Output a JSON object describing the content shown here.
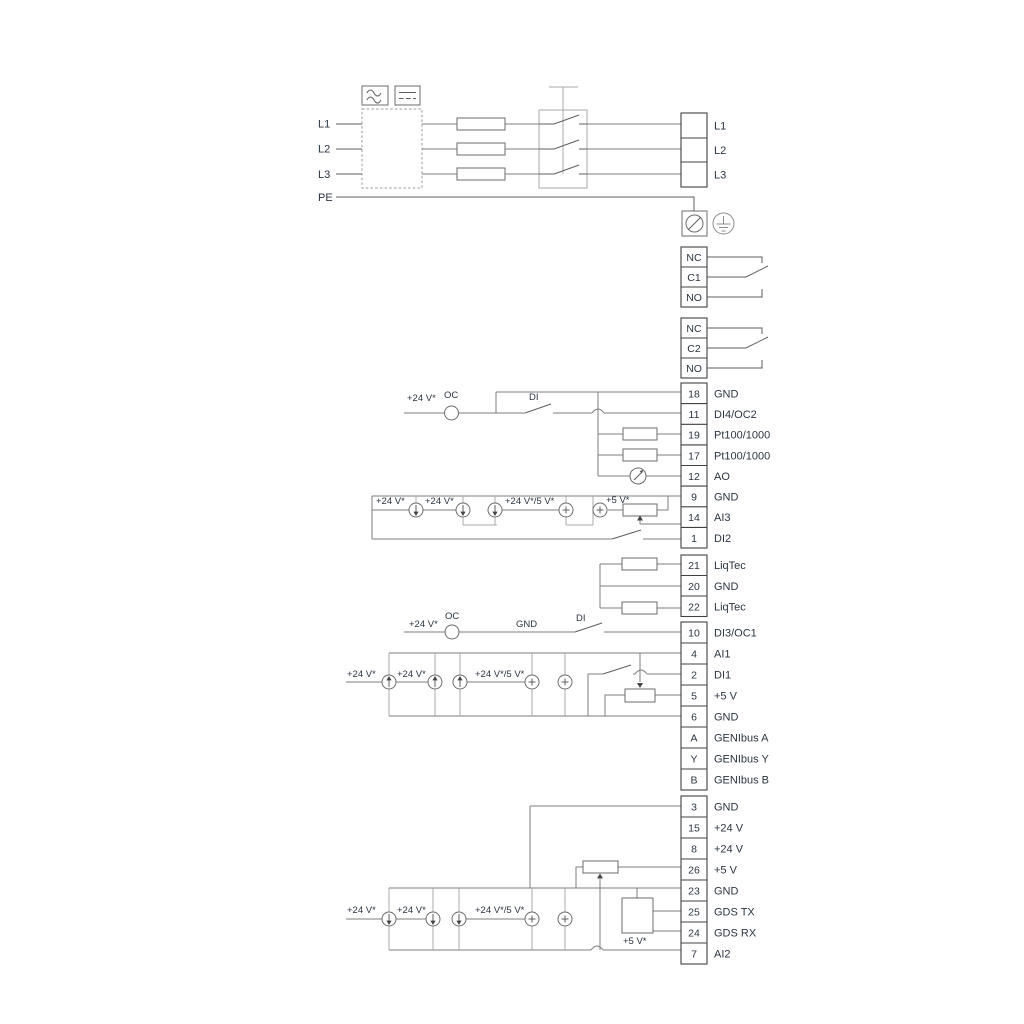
{
  "power": {
    "inputs": [
      "L1",
      "L2",
      "L3",
      "PE"
    ],
    "outputs": [
      "L1",
      "L2",
      "L3"
    ]
  },
  "relays": {
    "r1": [
      "NC",
      "C1",
      "NO"
    ],
    "r2": [
      "NC",
      "C2",
      "NO"
    ]
  },
  "strips": {
    "s1": [
      {
        "no": "18",
        "label": "GND"
      },
      {
        "no": "11",
        "label": "DI4/OC2"
      },
      {
        "no": "19",
        "label": "Pt100/1000"
      },
      {
        "no": "17",
        "label": "Pt100/1000"
      },
      {
        "no": "12",
        "label": "AO"
      },
      {
        "no": "9",
        "label": "GND"
      },
      {
        "no": "14",
        "label": "AI3"
      },
      {
        "no": "1",
        "label": "DI2"
      }
    ],
    "s2": [
      {
        "no": "21",
        "label": "LiqTec"
      },
      {
        "no": "20",
        "label": "GND"
      },
      {
        "no": "22",
        "label": "LiqTec"
      }
    ],
    "s3": [
      {
        "no": "10",
        "label": "DI3/OC1"
      },
      {
        "no": "4",
        "label": "AI1"
      },
      {
        "no": "2",
        "label": "DI1"
      },
      {
        "no": "5",
        "label": "+5 V"
      },
      {
        "no": "6",
        "label": "GND"
      },
      {
        "no": "A",
        "label": "GENIbus A"
      },
      {
        "no": "Y",
        "label": "GENIbus Y"
      },
      {
        "no": "B",
        "label": "GENIbus B"
      }
    ],
    "s4": [
      {
        "no": "3",
        "label": "GND"
      },
      {
        "no": "15",
        "label": "+24 V"
      },
      {
        "no": "8",
        "label": "+24 V"
      },
      {
        "no": "26",
        "label": "+5 V"
      },
      {
        "no": "23",
        "label": "GND"
      },
      {
        "no": "25",
        "label": "GDS TX"
      },
      {
        "no": "24",
        "label": "GDS RX"
      },
      {
        "no": "7",
        "label": "AI2"
      }
    ]
  },
  "ann": {
    "s1_v24": "+24 V*",
    "s1_oc": "OC",
    "s1_di": "DI",
    "ai3_v24a": "+24 V*",
    "ai3_v24b": "+24 V*",
    "ai3_v245": "+24 V*/5 V*",
    "ai3_v5": "+5 V*",
    "s3_v24": "+24 V*",
    "s3_oc": "OC",
    "s3_gnd": "GND",
    "s3_di": "DI",
    "ai1_v24a": "+24 V*",
    "ai1_v24b": "+24 V*",
    "ai1_v245": "+24 V*/5 V*",
    "ai2_v24a": "+24 V*",
    "ai2_v24b": "+24 V*",
    "ai2_v245": "+24 V*/5 V*",
    "ai2_v5": "+5 V*"
  },
  "colors": {
    "wire": "#7d7d7d",
    "rail": "#a8a8a8",
    "outline": "#414141",
    "text": "#2b3440",
    "background": "#ffffff"
  }
}
